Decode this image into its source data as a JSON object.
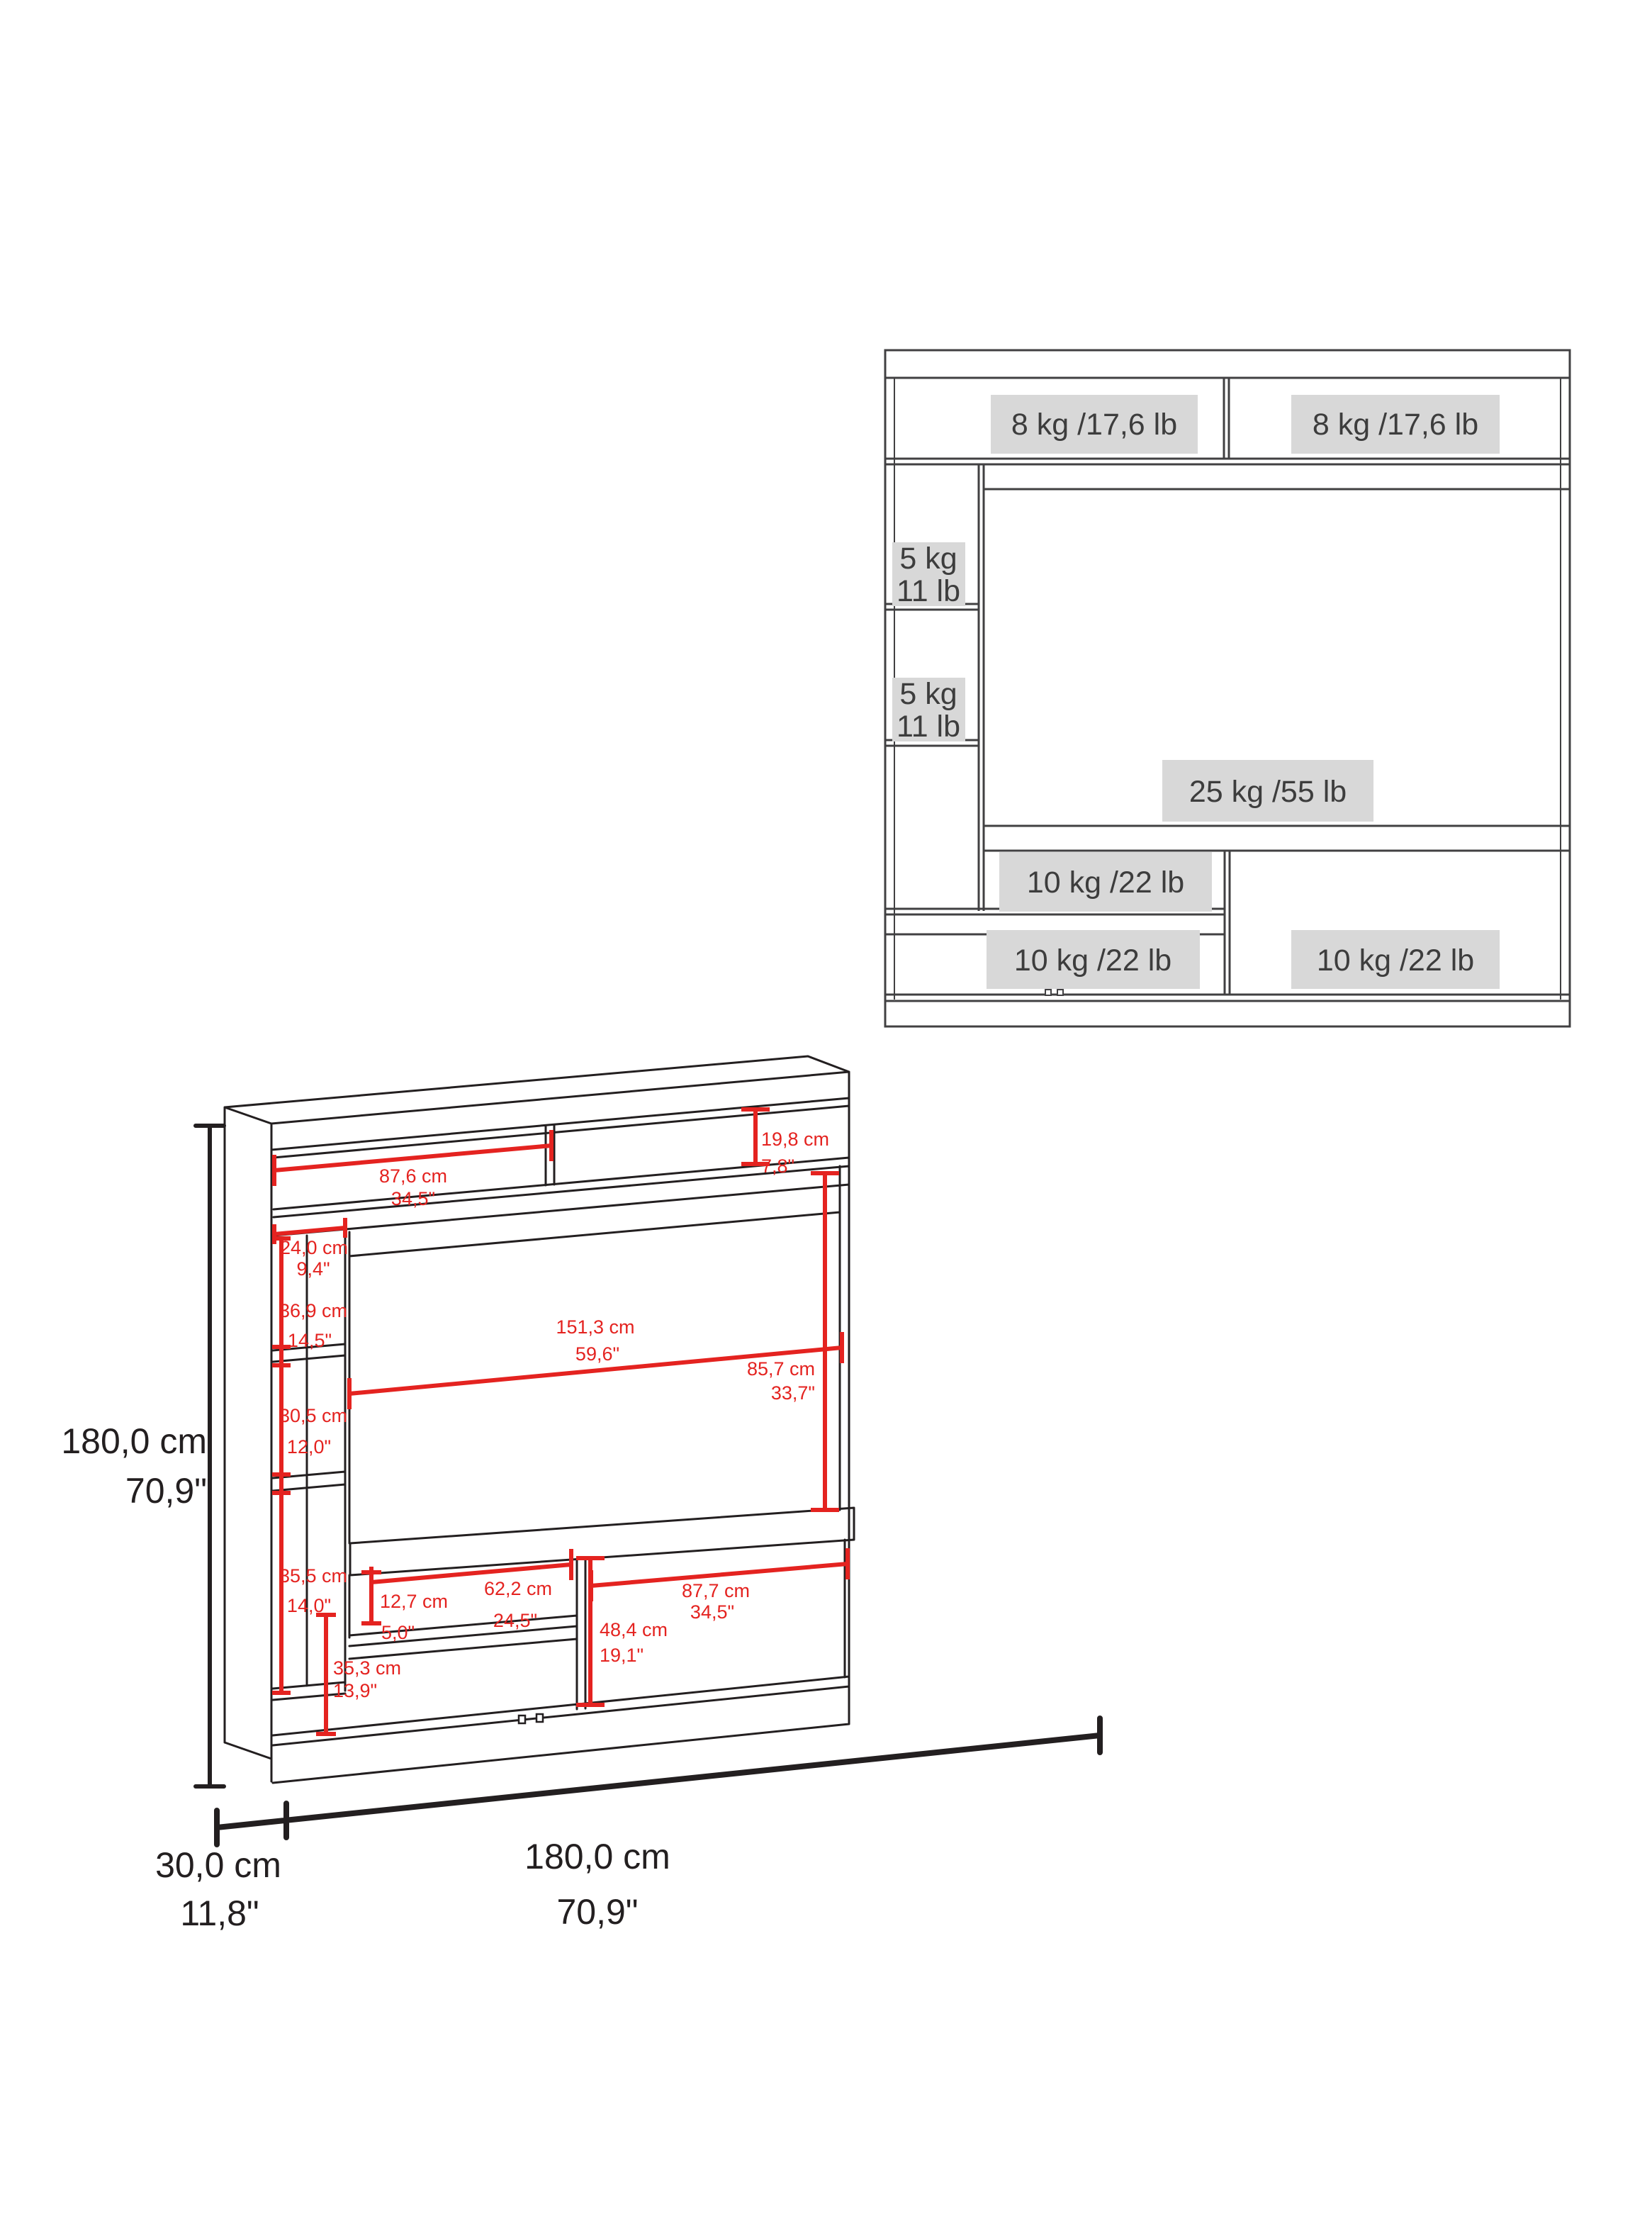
{
  "weight_diagram": {
    "top_shelves": [
      "8 kg /17,6 lb",
      "8 kg /17,6 lb"
    ],
    "side_shelves": [
      {
        "kg": "5 kg",
        "lb": "11 lb"
      },
      {
        "kg": "5 kg",
        "lb": "11 lb"
      }
    ],
    "tv_area": "25 kg /55 lb",
    "niche": "10 kg /22 lb",
    "bottom_left": "10 kg /22 lb",
    "bottom_right": "10 kg /22 lb"
  },
  "dimension_diagram": {
    "overall_height": {
      "cm": "180,0 cm",
      "in": "70,9\""
    },
    "overall_depth": {
      "cm": "30,0 cm",
      "in": "11,8\""
    },
    "overall_width": {
      "cm": "180,0 cm",
      "in": "70,9\""
    },
    "top_shelf_width": {
      "cm": "87,6 cm",
      "in": "34,5\""
    },
    "top_right_height": {
      "cm": "19,8 cm",
      "in": "7,8\""
    },
    "column_width": {
      "cm": "24,0 cm",
      "in": "9,4\""
    },
    "cubby_top_height": {
      "cm": "36,9 cm",
      "in": "14,5\""
    },
    "cubby_mid_height": {
      "cm": "30,5 cm",
      "in": "12,0\""
    },
    "cubby_bottom_height": {
      "cm": "35,5 cm",
      "in": "14,0\""
    },
    "tv_width": {
      "cm": "151,3 cm",
      "in": "59,6\""
    },
    "tv_height": {
      "cm": "85,7 cm",
      "in": "33,7\""
    },
    "niche_height": {
      "cm": "12,7 cm",
      "in": "5,0\""
    },
    "niche_width": {
      "cm": "62,2 cm",
      "in": "24,5\""
    },
    "right_comp_height": {
      "cm": "48,4 cm",
      "in": "19,1\""
    },
    "right_comp_width": {
      "cm": "87,7 cm",
      "in": "34,5\""
    },
    "door_height": {
      "cm": "35,3 cm",
      "in": "13,9\""
    }
  },
  "colors": {
    "dimension_red": "#e42320",
    "wireframe_black": "#231f20",
    "weight_line_color": "#414042",
    "label_box_bg": "#d8d8d8",
    "label_text": "#3d3d3d"
  }
}
